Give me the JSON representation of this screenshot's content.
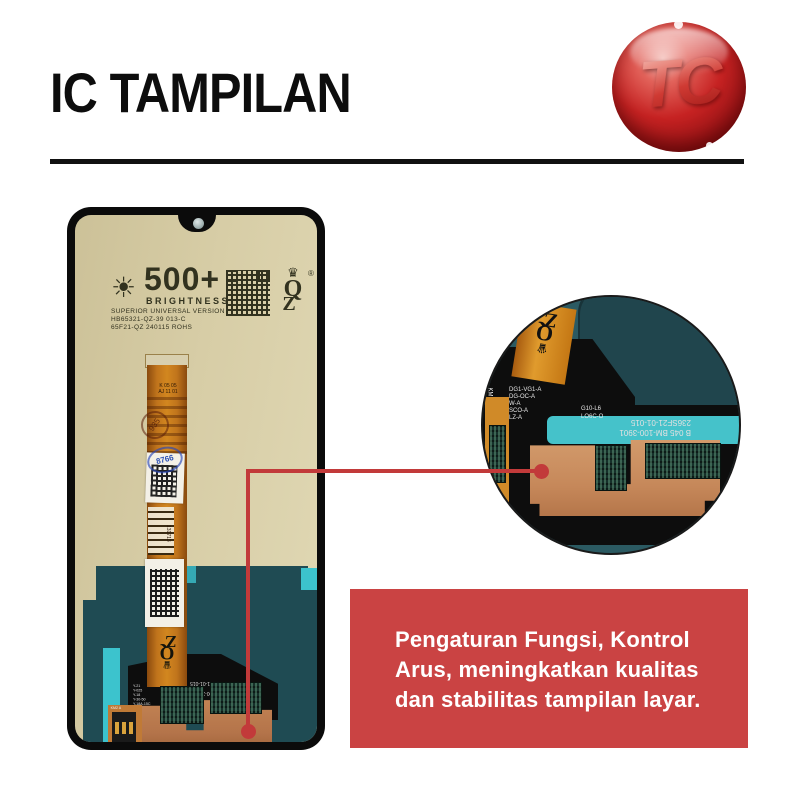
{
  "header": {
    "title": "IC TAMPILAN",
    "logo_text": "TC"
  },
  "callout": {
    "description_lines": [
      "Pengaturan Fungsi, Kontrol",
      "Arus, meningkatkan kualitas",
      "dan stabilitas tampilan layar."
    ]
  },
  "phone": {
    "print": {
      "brightness_value": "500+",
      "brightness_label": "BRIGHTNESS",
      "line1": "SUPERIOR UNIVERSAL VERSION",
      "line2": "HB65321-QZ-39 013-C",
      "line3": "65F21-QZ 240115 ROHS",
      "qz_crown": "♛",
      "qz_q": "Q",
      "qz_z": "Z",
      "qz_reg": "®"
    },
    "flex": {
      "mark1": "K 05 05",
      "mark2": "AJ 11 01",
      "stamp_text": "935",
      "blue_stamp_text": "8766",
      "label_text": "131713",
      "connector_label": "KM2 A"
    },
    "board": {
      "label_col": [
        "Y-21",
        "Y-025",
        "Y-18",
        "Y-30-50",
        "Y-18A-15C"
      ],
      "serial1": "236SF21-01-015",
      "serial2": "B 045 BM-100-3901"
    }
  },
  "magnifier": {
    "label_col": [
      "DG1-VG1-A",
      "DG-OC-A",
      "W-A",
      "SCO-A",
      "LZ-A"
    ],
    "label_right1": "G10-L6",
    "label_right2": "LO6C-O",
    "serial1": "236SF21-01-015",
    "serial2": "B 045 BM-100-3901",
    "micro1": "R8 MN948",
    "micro2": "CY-CN-PCV9",
    "side_label": "KM",
    "qz_crown": "♛",
    "qz_q": "Q",
    "qz_z": "Z"
  },
  "icons": {
    "brightness_sun": "☀"
  },
  "colors": {
    "accent_red": "#ca4343",
    "line_red": "#c23a3a",
    "lcd_tan": "#d7cda6",
    "panel_teal": "#1f4b53",
    "accent_cyan": "#3cc3cd",
    "flex_orange": "#c0741c",
    "copper_pad": "#b4744a",
    "logo_red": "#c62222"
  }
}
